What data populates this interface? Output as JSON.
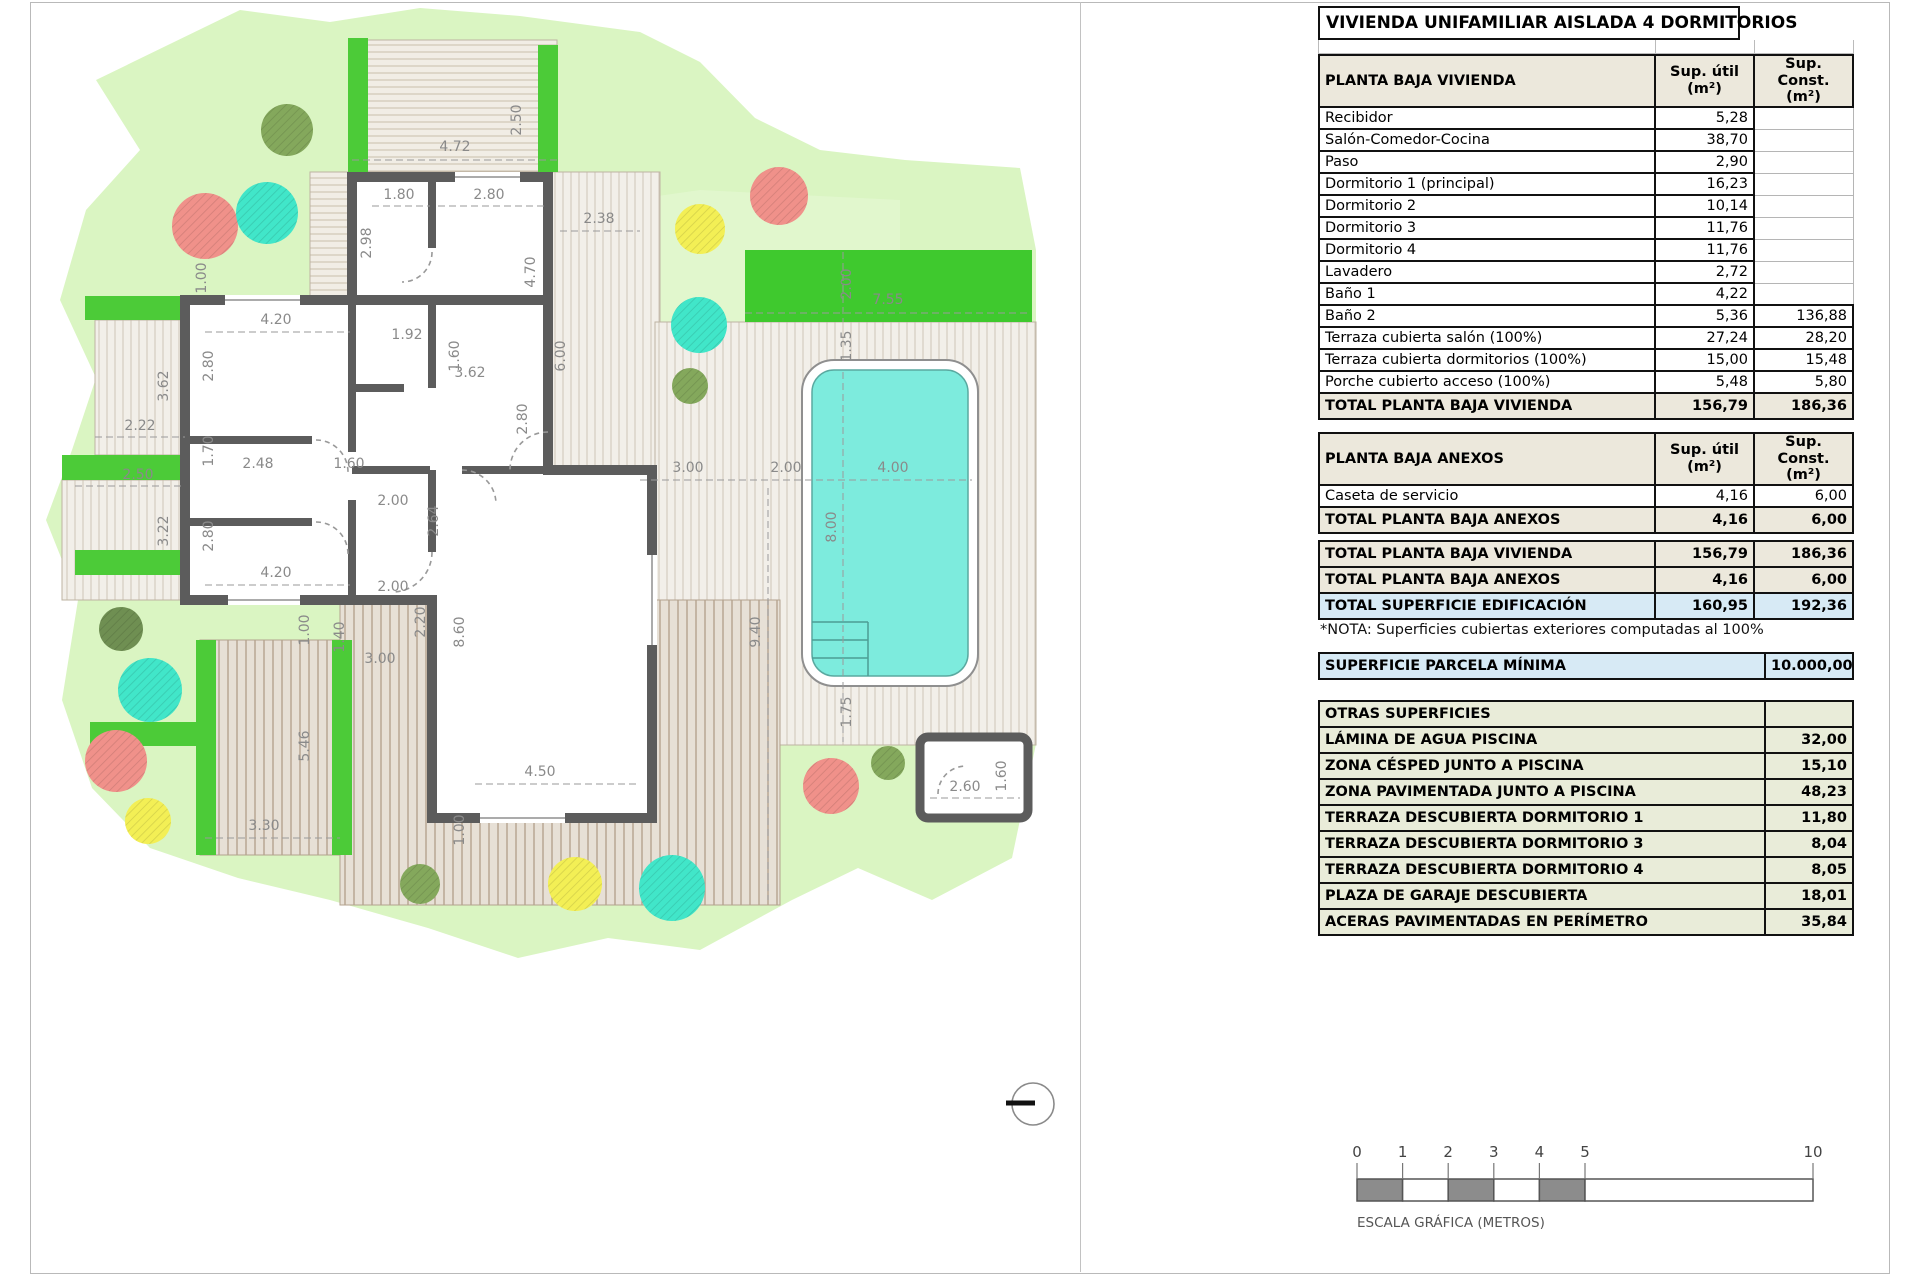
{
  "title": "VIVIENDA UNIFAMILIAR AISLADA 4 DORMITORIOS",
  "cols": {
    "util": "Sup. útil\n(m²)",
    "const": "Sup. Const.\n(m²)"
  },
  "tables": {
    "vivienda": {
      "title": "PLANTA BAJA VIVIENDA",
      "rows": [
        {
          "label": "Recibidor",
          "util": "5,28",
          "const": ""
        },
        {
          "label": "Salón-Comedor-Cocina",
          "util": "38,70",
          "const": ""
        },
        {
          "label": "Paso",
          "util": "2,90",
          "const": ""
        },
        {
          "label": "Dormitorio 1 (principal)",
          "util": "16,23",
          "const": ""
        },
        {
          "label": "Dormitorio 2",
          "util": "10,14",
          "const": ""
        },
        {
          "label": "Dormitorio 3",
          "util": "11,76",
          "const": ""
        },
        {
          "label": "Dormitorio 4",
          "util": "11,76",
          "const": ""
        },
        {
          "label": "Lavadero",
          "util": "2,72",
          "const": ""
        },
        {
          "label": "Baño 1",
          "util": "4,22",
          "const": ""
        },
        {
          "label": "Baño 2",
          "util": "5,36",
          "const": "136,88"
        },
        {
          "label": "Terraza cubierta salón (100%)",
          "util": "27,24",
          "const": "28,20"
        },
        {
          "label": "Terraza cubierta dormitorios (100%)",
          "util": "15,00",
          "const": "15,48"
        },
        {
          "label": "Porche cubierto acceso (100%)",
          "util": "5,48",
          "const": "5,80"
        }
      ],
      "total": {
        "label": "TOTAL PLANTA BAJA VIVIENDA",
        "util": "156,79",
        "const": "186,36"
      }
    },
    "anexos": {
      "title": "PLANTA BAJA ANEXOS",
      "rows": [
        {
          "label": "Caseta de servicio",
          "util": "4,16",
          "const": "6,00"
        }
      ],
      "total": {
        "label": "TOTAL PLANTA BAJA ANEXOS",
        "util": "4,16",
        "const": "6,00"
      }
    },
    "resumen": [
      {
        "label": "TOTAL PLANTA BAJA VIVIENDA",
        "util": "156,79",
        "const": "186,36",
        "style": "beige"
      },
      {
        "label": "TOTAL PLANTA BAJA ANEXOS",
        "util": "4,16",
        "const": "6,00",
        "style": "beige"
      },
      {
        "label": "TOTAL SUPERFICIE EDIFICACIÓN",
        "util": "160,95",
        "const": "192,36",
        "style": "blue"
      }
    ],
    "otras": {
      "title": "OTRAS SUPERFICIES",
      "rows": [
        {
          "label": "LÁMINA DE AGUA PISCINA",
          "value": "32,00"
        },
        {
          "label": "ZONA CÉSPED JUNTO A PISCINA",
          "value": "15,10"
        },
        {
          "label": "ZONA PAVIMENTADA JUNTO A PISCINA",
          "value": "48,23"
        },
        {
          "label": "TERRAZA DESCUBIERTA DORMITORIO 1",
          "value": "11,80"
        },
        {
          "label": "TERRAZA DESCUBIERTA DORMITORIO 3",
          "value": "8,04"
        },
        {
          "label": "TERRAZA DESCUBIERTA DORMITORIO 4",
          "value": "8,05"
        },
        {
          "label": "PLAZA DE GARAJE DESCUBIERTA",
          "value": "18,01"
        },
        {
          "label": "ACERAS PAVIMENTADAS EN PERÍMETRO",
          "value": "35,84"
        }
      ]
    }
  },
  "nota": "*NOTA: Superficies cubiertas exteriores computadas al 100%",
  "parcela": {
    "label": "SUPERFICIE PARCELA MÍNIMA",
    "value": "10.000,00"
  },
  "scale": {
    "ticks": [
      0,
      1,
      2,
      3,
      4,
      5,
      10
    ],
    "caption": "ESCALA GRÁFICA (METROS)"
  },
  "colors": {
    "parcel_green": "#daf5c2",
    "hedge_green": "#4ccb38",
    "pool_water": "#7debdd",
    "wall_gray": "#5c5c5c",
    "header_beige": "#ece8dc",
    "highlight_blue": "#d7eaf5",
    "otras_green": "#e9ecd9",
    "trees": {
      "coral": "#f0918a",
      "turquoise": "#41e6c9",
      "yellow": "#f3ef55",
      "olive": "#84a85c",
      "darkolive": "#6f8f52"
    }
  },
  "plan": {
    "dimensions": [
      {
        "v": "2.50",
        "x": 521,
        "y": 120,
        "r": -90
      },
      {
        "v": "4.72",
        "x": 455,
        "y": 151
      },
      {
        "v": "1.80",
        "x": 399,
        "y": 199
      },
      {
        "v": "2.80",
        "x": 489,
        "y": 199
      },
      {
        "v": "2.38",
        "x": 599,
        "y": 223
      },
      {
        "v": "2.98",
        "x": 371,
        "y": 243,
        "r": -90
      },
      {
        "v": "4.70",
        "x": 535,
        "y": 272,
        "r": -90
      },
      {
        "v": "1.00",
        "x": 206,
        "y": 278,
        "r": -90
      },
      {
        "v": "4.20",
        "x": 276,
        "y": 324
      },
      {
        "v": "1.92",
        "x": 407,
        "y": 339
      },
      {
        "v": "1.60",
        "x": 459,
        "y": 356,
        "r": -90
      },
      {
        "v": "6.00",
        "x": 565,
        "y": 356,
        "r": -90
      },
      {
        "v": "3.62",
        "x": 470,
        "y": 377
      },
      {
        "v": "2.80",
        "x": 213,
        "y": 366,
        "r": -90
      },
      {
        "v": "3.62",
        "x": 168,
        "y": 386,
        "r": -90
      },
      {
        "v": "2.22",
        "x": 140,
        "y": 430
      },
      {
        "v": "2.80",
        "x": 527,
        "y": 419,
        "r": -90
      },
      {
        "v": "1.70",
        "x": 213,
        "y": 451,
        "r": -90
      },
      {
        "v": "2.48",
        "x": 258,
        "y": 468
      },
      {
        "v": "1.60",
        "x": 349,
        "y": 468
      },
      {
        "v": "2.50",
        "x": 138,
        "y": 479
      },
      {
        "v": "2.00",
        "x": 393,
        "y": 505
      },
      {
        "v": "3.22",
        "x": 168,
        "y": 531,
        "r": -90
      },
      {
        "v": "2.64",
        "x": 438,
        "y": 521,
        "r": -90
      },
      {
        "v": "2.80",
        "x": 213,
        "y": 536,
        "r": -90
      },
      {
        "v": "4.20",
        "x": 276,
        "y": 577
      },
      {
        "v": "2.00",
        "x": 393,
        "y": 591
      },
      {
        "v": "3.00",
        "x": 688,
        "y": 472
      },
      {
        "v": "2.00",
        "x": 786,
        "y": 472
      },
      {
        "v": "4.00",
        "x": 893,
        "y": 472
      },
      {
        "v": "8.00",
        "x": 836,
        "y": 527,
        "r": -90
      },
      {
        "v": "9.40",
        "x": 760,
        "y": 632,
        "r": -90
      },
      {
        "v": "7.55",
        "x": 888,
        "y": 304
      },
      {
        "v": "2.00",
        "x": 851,
        "y": 284,
        "r": -90
      },
      {
        "v": "1.35",
        "x": 851,
        "y": 346,
        "r": -90
      },
      {
        "v": "1.75",
        "x": 851,
        "y": 712,
        "r": -90
      },
      {
        "v": "8.60",
        "x": 464,
        "y": 632,
        "r": -90
      },
      {
        "v": "2.20",
        "x": 425,
        "y": 622,
        "r": -90
      },
      {
        "v": "1.40",
        "x": 344,
        "y": 637,
        "r": -90
      },
      {
        "v": "1.00",
        "x": 309,
        "y": 630,
        "r": -90
      },
      {
        "v": "3.00",
        "x": 380,
        "y": 663
      },
      {
        "v": "5.46",
        "x": 309,
        "y": 746,
        "r": -90
      },
      {
        "v": "4.50",
        "x": 540,
        "y": 776
      },
      {
        "v": "3.30",
        "x": 264,
        "y": 830
      },
      {
        "v": "1.00",
        "x": 464,
        "y": 830,
        "r": -90
      },
      {
        "v": "2.60",
        "x": 965,
        "y": 791
      },
      {
        "v": "1.60",
        "x": 1006,
        "y": 776,
        "r": -90
      }
    ],
    "dim_lines": [
      [
        352,
        160,
        558,
        160
      ],
      [
        372,
        206,
        430,
        206
      ],
      [
        438,
        206,
        545,
        206
      ],
      [
        560,
        231,
        640,
        231
      ],
      [
        205,
        332,
        350,
        332
      ],
      [
        205,
        585,
        350,
        585
      ],
      [
        95,
        437,
        185,
        437
      ],
      [
        75,
        486,
        185,
        486
      ],
      [
        640,
        480,
        972,
        480
      ],
      [
        843,
        372,
        843,
        676
      ],
      [
        843,
        252,
        843,
        322
      ],
      [
        843,
        682,
        843,
        742
      ],
      [
        745,
        313,
        1030,
        313
      ],
      [
        768,
        488,
        768,
        900
      ],
      [
        475,
        784,
        640,
        784
      ],
      [
        205,
        838,
        340,
        838
      ],
      [
        930,
        798,
        1020,
        798
      ]
    ],
    "trees": [
      {
        "x": 287,
        "y": 130,
        "r": 26,
        "c": "olive"
      },
      {
        "x": 205,
        "y": 226,
        "r": 33,
        "c": "coral"
      },
      {
        "x": 267,
        "y": 213,
        "r": 31,
        "c": "turquoise"
      },
      {
        "x": 779,
        "y": 196,
        "r": 29,
        "c": "coral"
      },
      {
        "x": 700,
        "y": 229,
        "r": 25,
        "c": "yellow"
      },
      {
        "x": 699,
        "y": 325,
        "r": 28,
        "c": "turquoise"
      },
      {
        "x": 690,
        "y": 386,
        "r": 18,
        "c": "olive"
      },
      {
        "x": 121,
        "y": 629,
        "r": 22,
        "c": "darkolive"
      },
      {
        "x": 150,
        "y": 690,
        "r": 32,
        "c": "turquoise"
      },
      {
        "x": 116,
        "y": 761,
        "r": 31,
        "c": "coral"
      },
      {
        "x": 148,
        "y": 821,
        "r": 23,
        "c": "yellow"
      },
      {
        "x": 420,
        "y": 884,
        "r": 20,
        "c": "olive"
      },
      {
        "x": 575,
        "y": 884,
        "r": 27,
        "c": "yellow"
      },
      {
        "x": 672,
        "y": 888,
        "r": 33,
        "c": "turquoise"
      },
      {
        "x": 831,
        "y": 786,
        "r": 28,
        "c": "coral"
      },
      {
        "x": 888,
        "y": 763,
        "r": 17,
        "c": "olive"
      }
    ]
  }
}
